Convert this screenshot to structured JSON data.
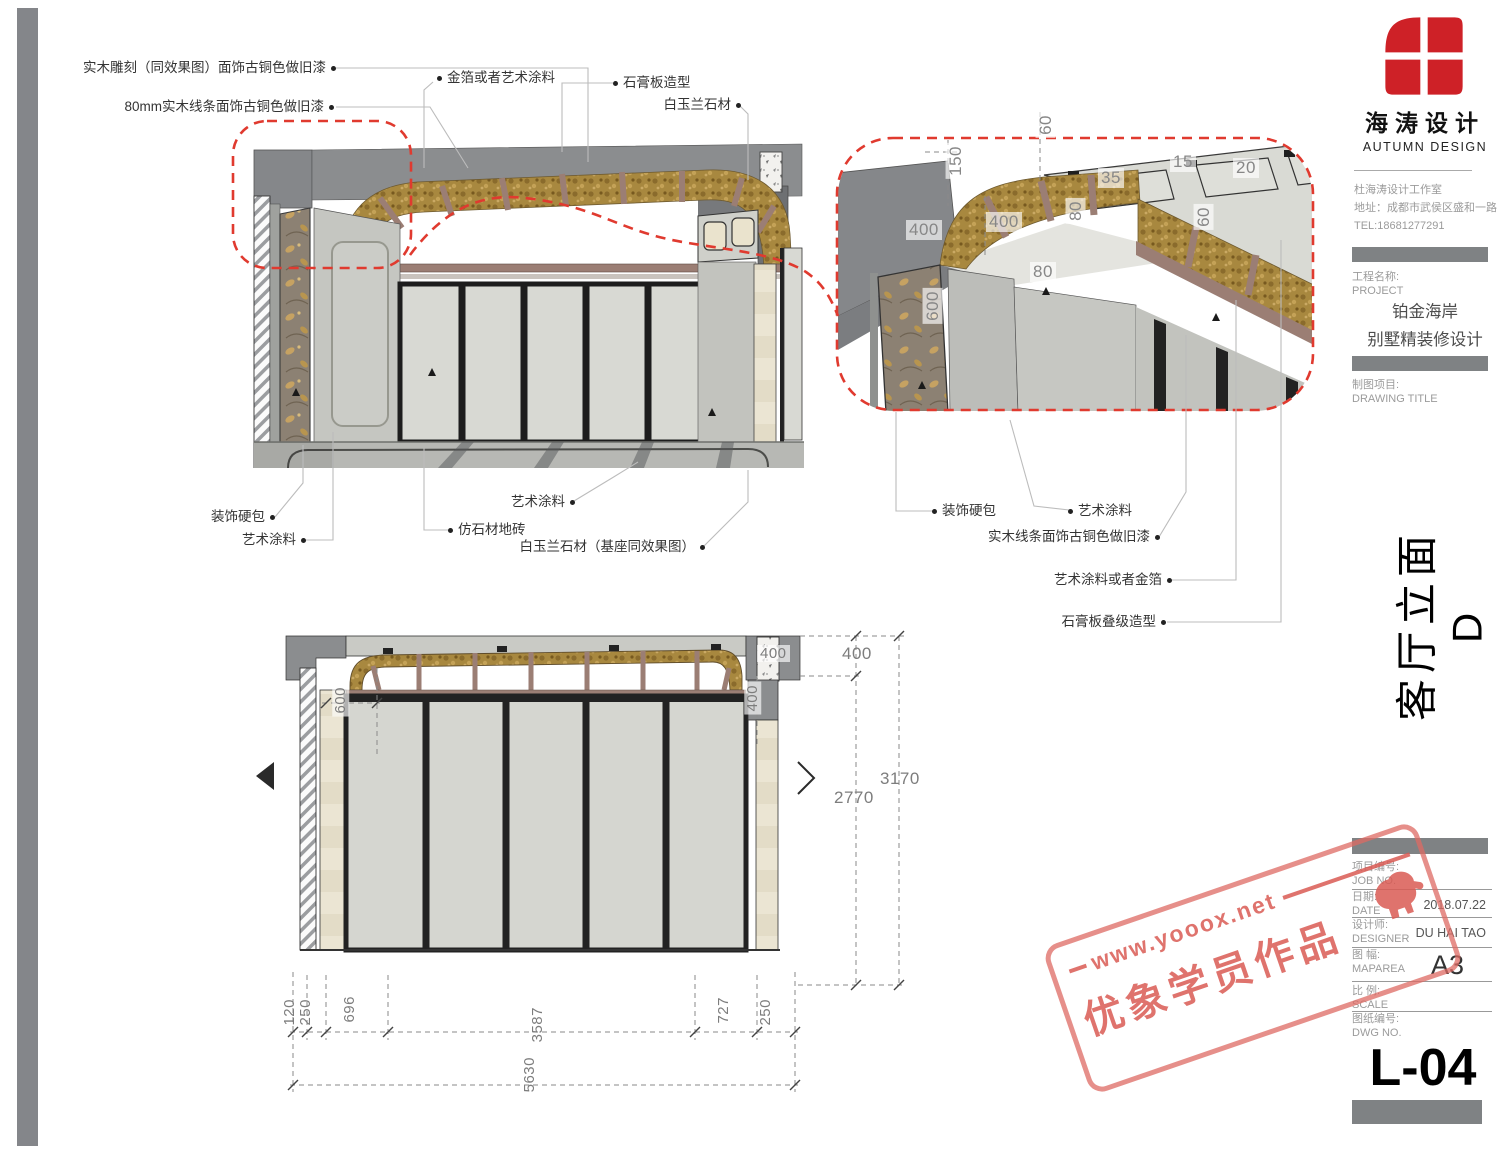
{
  "brand": {
    "name": "海涛设计",
    "name_en": "AUTUMN DESIGN"
  },
  "studio": {
    "name": "杜海涛设计工作室",
    "address": "地址：成都市武侯区盛和一路",
    "tel": "TEL:18681277291"
  },
  "title_block": {
    "project_label": "工程名称:",
    "project_label_en": "PROJECT",
    "project_line1": "铂金海岸",
    "project_line2": "别墅精装修设计",
    "drawing_label": "制图项目:",
    "drawing_label_en": "DRAWING TITLE",
    "drawing_title": "客厅立面D",
    "fields": [
      {
        "label": "项目编号:",
        "label_en": "JOB NO.",
        "value": ""
      },
      {
        "label": "日期:",
        "label_en": "DATE",
        "value": "2018.07.22"
      },
      {
        "label": "设计师:",
        "label_en": "DESIGNER",
        "value": "DU HAI TAO"
      },
      {
        "label": "图 幅:",
        "label_en": "MAPAREA",
        "value": "A3"
      },
      {
        "label": "比 例:",
        "label_en": "SCALE",
        "value": ""
      },
      {
        "label": "图纸编号:",
        "label_en": "DWG NO.",
        "value": ""
      }
    ],
    "sheet_no": "L-04"
  },
  "callouts": {
    "c1": "实木雕刻（同效果图）面饰古铜色做旧漆",
    "c2": "80mm实木线条面饰古铜色做旧漆",
    "c3": "金箔或者艺术涂料",
    "c4": "石膏板造型",
    "c5": "白玉兰石材",
    "c6": "装饰硬包",
    "c7": "艺术涂料",
    "c8": "艺术涂料",
    "c9": "仿石材地砖",
    "c10": "白玉兰石材（基座同效果图）",
    "d1": "装饰硬包",
    "d2": "艺术涂料",
    "d3": "实木线条面饰古铜色做旧漆",
    "d4": "艺术涂料或者金箔",
    "d5": "石膏板叠级造型"
  },
  "detail_dims": [
    "150",
    "60",
    "35",
    "15",
    "20",
    "400",
    "400",
    "80",
    "60",
    "80",
    "600"
  ],
  "elevation_dims": {
    "top_400": "400",
    "right_400_rot": "400",
    "left_600_rot": "600",
    "v400": "400",
    "v2770": "2770",
    "v3170": "3170",
    "b120": "120",
    "b250a": "250",
    "b696": "696",
    "b3587": "3587",
    "b727": "727",
    "b250b": "250",
    "b5630": "5630"
  },
  "watermark": {
    "site": "www.yooox.net",
    "caption": "优象学员作品"
  },
  "colors": {
    "accent_red": "#e03a2f",
    "logo_red": "#ce2127",
    "stamp_pink": "#de6a63",
    "bar_gray": "#7f8284",
    "gold": "#a8883f",
    "bronze": "#9b7e74"
  }
}
